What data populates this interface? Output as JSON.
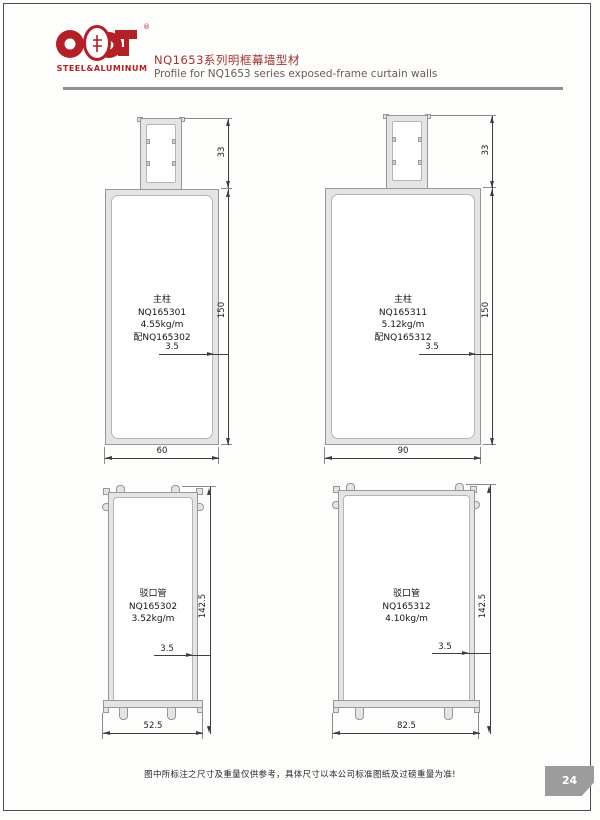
{
  "header": {
    "logo_brand": "STEEL&ALUMINUM",
    "logo_reg": "®",
    "title_cn": "NQ1653系列明框幕墙型材",
    "title_en": "Profile for NQ1653 series exposed-frame curtain walls"
  },
  "drawings": [
    {
      "name_cn": "主柱",
      "code": "NQ165301",
      "weight": "4.55kg/m",
      "match": "配NQ165302",
      "dim_top": "33",
      "dim_side": "150",
      "dim_wall": "3.5",
      "dim_bottom": "60"
    },
    {
      "name_cn": "主柱",
      "code": "NQ165311",
      "weight": "5.12kg/m",
      "match": "配NQ165312",
      "dim_top": "33",
      "dim_side": "150",
      "dim_wall": "3.5",
      "dim_bottom": "90"
    },
    {
      "name_cn": "驳口管",
      "code": "NQ165302",
      "weight": "3.52kg/m",
      "dim_side": "142.5",
      "dim_wall": "3.5",
      "dim_bottom": "52.5"
    },
    {
      "name_cn": "驳口管",
      "code": "NQ165312",
      "weight": "4.10kg/m",
      "dim_side": "142.5",
      "dim_wall": "3.5",
      "dim_bottom": "82.5"
    }
  ],
  "footer": {
    "note": "图中所标注之尺寸及重量仅供参考，具体尺寸以本公司标准图纸及过磅重量为准!",
    "page_number": "24"
  },
  "colors": {
    "brand_red": "#b32025",
    "badge_gray": "#9c9c9c",
    "profile_fill": "#e4e4e4"
  }
}
